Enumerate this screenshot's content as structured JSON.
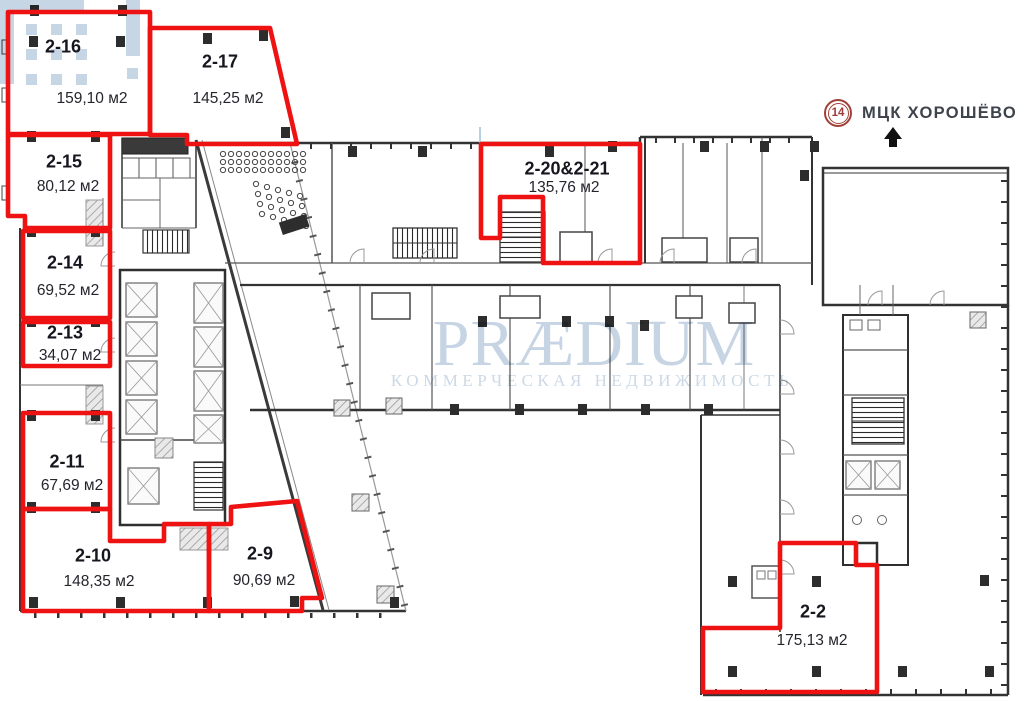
{
  "watermark": {
    "brand": "PRÆDIUM",
    "tagline": "КОММЕРЧЕСКАЯ НЕДВИЖИМОСТЬ"
  },
  "transit": {
    "line": "14",
    "station": "МЦК ХОРОШЁВО"
  },
  "units": [
    {
      "id": "2-16",
      "area": "159,10 м2"
    },
    {
      "id": "2-17",
      "area": "145,25 м2"
    },
    {
      "id": "2-15",
      "area": "80,12 м2"
    },
    {
      "id": "2-14",
      "area": "69,52 м2"
    },
    {
      "id": "2-13",
      "area": "34,07 м2"
    },
    {
      "id": "2-11",
      "area": "67,69 м2"
    },
    {
      "id": "2-10",
      "area": "148,35 м2"
    },
    {
      "id": "2-9",
      "area": "90,69 м2"
    },
    {
      "id": "2-20&2-21",
      "area": "135,76 м2"
    },
    {
      "id": "2-2",
      "area": "175,13 м2"
    }
  ],
  "colors": {
    "unit_outline": "#ee1212",
    "watermark": "#c7d6e5",
    "badge": "#a04038",
    "label_text": "#16161e",
    "walls": "#333333"
  }
}
